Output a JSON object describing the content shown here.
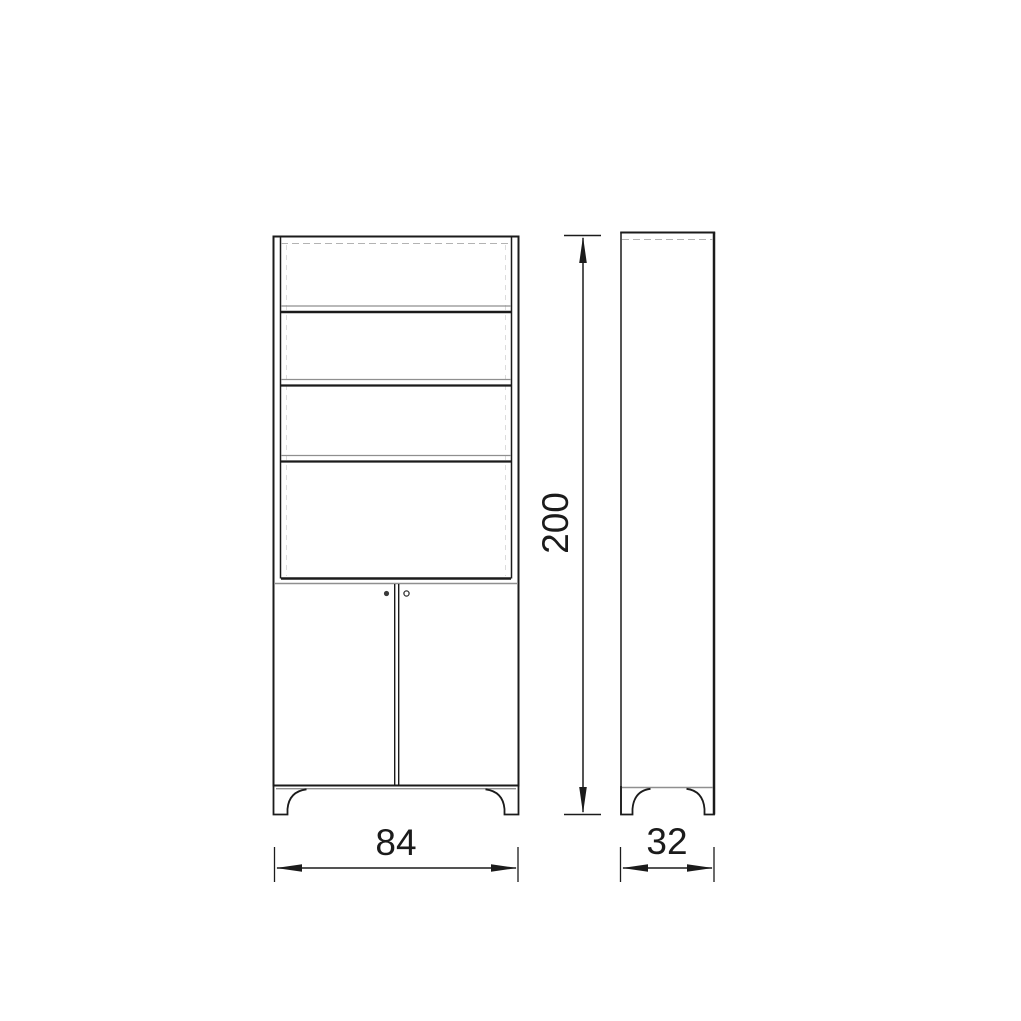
{
  "drawing": {
    "kind": "cabinet-dimension-diagram",
    "views": {
      "front_view": "cabinet front elevation with three shelves and two doors",
      "side_view": "cabinet side elevation"
    },
    "dimensions": {
      "width": "84",
      "depth": "32",
      "height": "200"
    },
    "colors": {
      "line": "#1b1b1b",
      "muted_line": "#8f8f8f",
      "background": "#ffffff"
    }
  }
}
